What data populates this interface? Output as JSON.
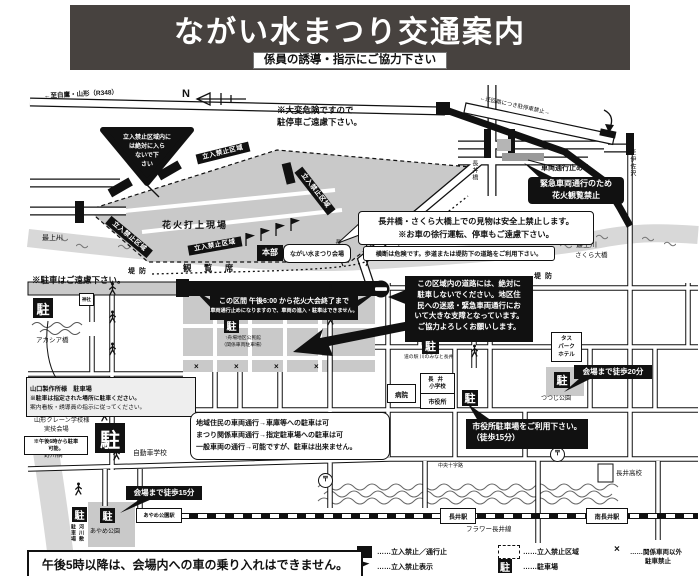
{
  "header": {
    "title": "ながい水まつり交通案内",
    "subtitle": "係員の誘導・指示にご協力下さい"
  },
  "icons": {
    "parking": "駐",
    "postal": "〒",
    "x_mark": "×",
    "compass_n": "N"
  },
  "roads": {
    "r348": "←至白鷹・山形（R348）",
    "detour": "←迂回路につき駐停車禁止→",
    "to_isazawa": "↑至伊佐沢",
    "nagai_bridge": "長井橋",
    "sakura_bridge": "さくら大橋",
    "acacia_bridge": "アカシア橋",
    "nogawa_bridge": "野川橋",
    "teibo": "堤防",
    "chuo_crossroad": "中央十字路",
    "flower_line": "フラワー長井線",
    "mogami_river": "最上川"
  },
  "areas": {
    "fireworks_site": "花火打上現場",
    "kanranseki": "観 覧 席",
    "honbu": "本部",
    "venue": "ながい水まつり会場",
    "no_entry_zone": "立入禁止区域",
    "tsutsuji_park": "つつじ公園",
    "ayame_park": "あやめ公園",
    "jinja": "神社",
    "kasen_col1": "駐車場",
    "kasen_col2": "河川敷"
  },
  "places": {
    "hospital": "病院",
    "elem1": "長井",
    "elem2": "小学校",
    "city_hall": "市役所",
    "michinoeki": "道の駅 川のみなと長井",
    "tas1": "タス",
    "tas2": "パーク",
    "tas3": "ホテル",
    "highschool": "長井高校",
    "driving_school": "自動車学校",
    "nagai_station": "長井駅",
    "minami_station": "南長井駅",
    "ayame_station": "あやめ公園駅"
  },
  "notes": {
    "danger1": "※大変危険ですので",
    "danger2": "駐停車ご遠慮下さい。",
    "tri1": "立入禁止区域内に",
    "tri2": "は絶対に入ら",
    "tri3": "ないで下",
    "tri4": "さい",
    "vehicle_closed": "車両通行止め",
    "emerg1": "緊急車両通行のため",
    "emerg2": "花火観覧禁止",
    "bridge1": "長井橋・さくら大橋上での見物は安全上禁止します。",
    "bridge2": "※お車の徐行運転、停車もご遠慮下さい。",
    "crossing": "横断は危険です。歩道または堤防下の道路をご利用下さい。",
    "levee_no_parking": "※駐車はご遠慮下さい。",
    "closed1": "この区間 午後6:00 から花火大会終了まで",
    "closed2": "車両通行止めになりますので、車両の進入・駐車はできません。",
    "funaba1": "↑舟場地区公民館",
    "funaba2": "（関係車両駐車場）",
    "yama1": "山口製作所様　駐車場",
    "yama2": "※駐車は指定された場所に駐車ください。",
    "yama3": "案内看板・誘導員の指示に従ってください。",
    "area1": "この区域内の道路には、絶対に",
    "area2": "駐車しないでください。地区住",
    "area3": "民への迷惑・緊急車両通行にお",
    "area4": "いて大きな支障となっています。",
    "area5": "ご協力よろしくお願いします。",
    "walk20": "会場まで徒歩20分",
    "walk15": "会場まで徒歩15分",
    "cityhall1": "市役所駐車場をご利用下さい。",
    "cityhall2": "（徒歩15分）",
    "res1": "地域住民の車両通行→車庫等への駐車は可",
    "res2": "まつり関係車両通行→指定駐車場への駐車は可",
    "res3": "一般車両の通行→可能ですが、駐車は出来ません。",
    "crane1": "山形クレーン学校様",
    "crane2": "実技会場",
    "crane3": "※午後6時から駐車",
    "crane4": "可能。"
  },
  "footer": {
    "notice": "午後5時以降は、会場内への車の乗り入れはできません。"
  },
  "legend": {
    "l1": "……立入禁止／通行止",
    "l2": "……立入禁止表示",
    "l3": "……立入禁止区域",
    "l4": "……駐車場",
    "l5a": "……関係車両以外",
    "l5b": "駐車禁止"
  },
  "colors": {
    "header_bg": "#47423f",
    "zone_gray": "#c9c9c9",
    "river_gray": "#d8d8d8",
    "ink": "#111111"
  }
}
